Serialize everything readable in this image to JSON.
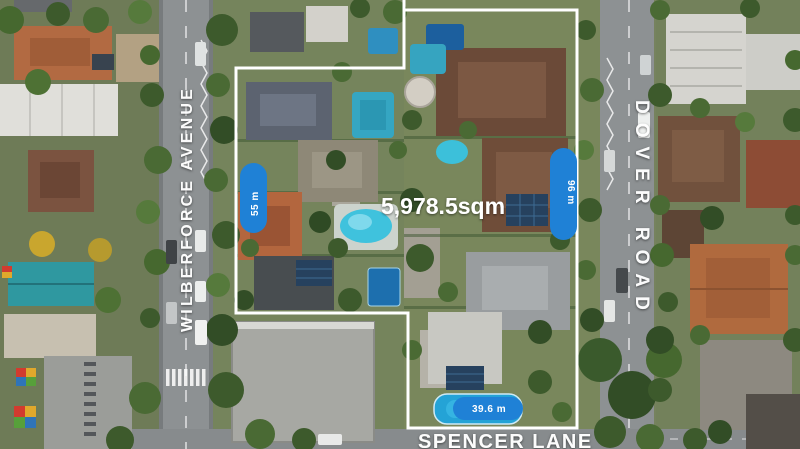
{
  "title": "aerial-property-outline",
  "area_label": "5,978.5sqm",
  "streets": {
    "left": "WILBERFORCE AVENUE",
    "right": "DOVER ROAD",
    "bottom": "SPENCER LANE"
  },
  "measurements": {
    "west_boundary": "55 m",
    "east_boundary": "96 m",
    "south_frontage": "39.6 m"
  },
  "colors": {
    "measurement_pill": "#1f81d6",
    "boundary_line": "#ffffff",
    "street_text": "#ffffff",
    "area_text": "#ffffff"
  }
}
